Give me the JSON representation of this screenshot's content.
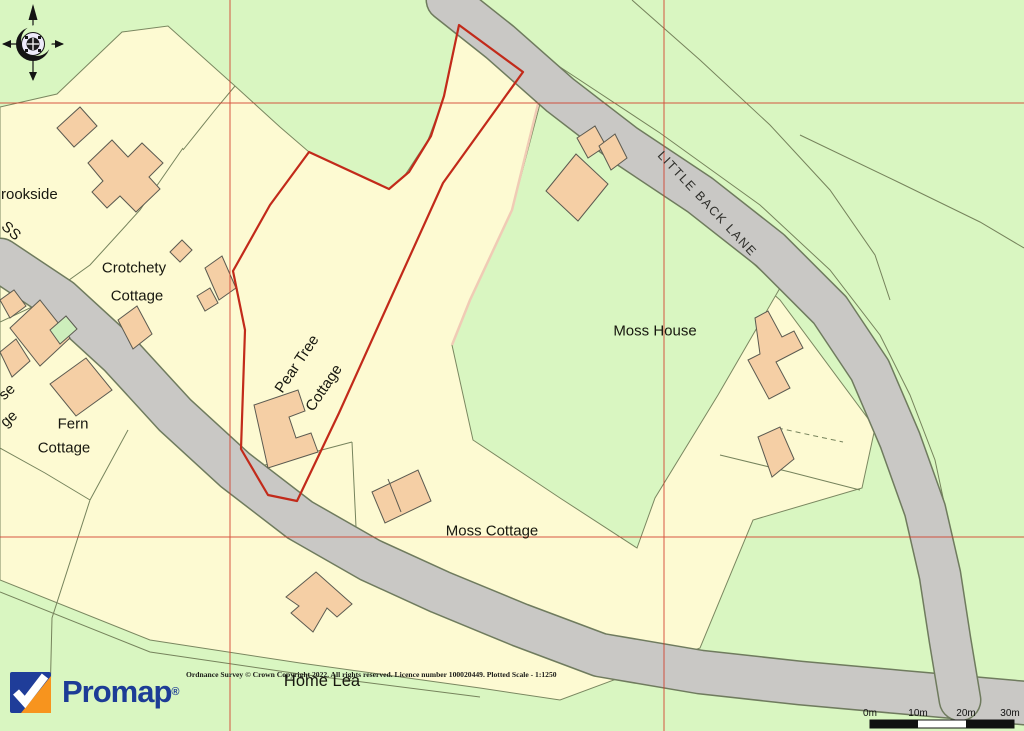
{
  "map": {
    "labels": {
      "brookside": "rookside",
      "road_partial": "SS",
      "crotchety_line1": "Crotchety",
      "crotchety_line2": "Cottage",
      "left_partial_1": "se",
      "left_partial_2": "ge",
      "fern_line1": "Fern",
      "fern_line2": "Cottage",
      "pear_tree_line1": "Pear Tree",
      "pear_tree_line2": "Cottage",
      "moss_house": "Moss House",
      "moss_cottage": "Moss Cottage",
      "home_lea": "Home Lea",
      "little_back_lane": "LITTLE BACK LANE"
    },
    "colors": {
      "field_green": "#d9f6c1",
      "parcel_yellow": "#fdfad2",
      "road_gray": "#c9c8c5",
      "building_peach": "#f5cfa5",
      "site_boundary_red": "#c22a1a",
      "grid_red": "#d23a28",
      "promap_blue": "#1d3c96",
      "promap_orange": "#f7941e"
    }
  },
  "scale_bar": {
    "labels": [
      "0m",
      "10m",
      "20m",
      "30m"
    ]
  },
  "footer": {
    "logo_text": "Promap",
    "registered_mark": "®",
    "copyright": "Ordnance Survey © Crown Copyright 2022. All rights reserved. Licence number 100020449. Plotted Scale -  1:1250"
  }
}
